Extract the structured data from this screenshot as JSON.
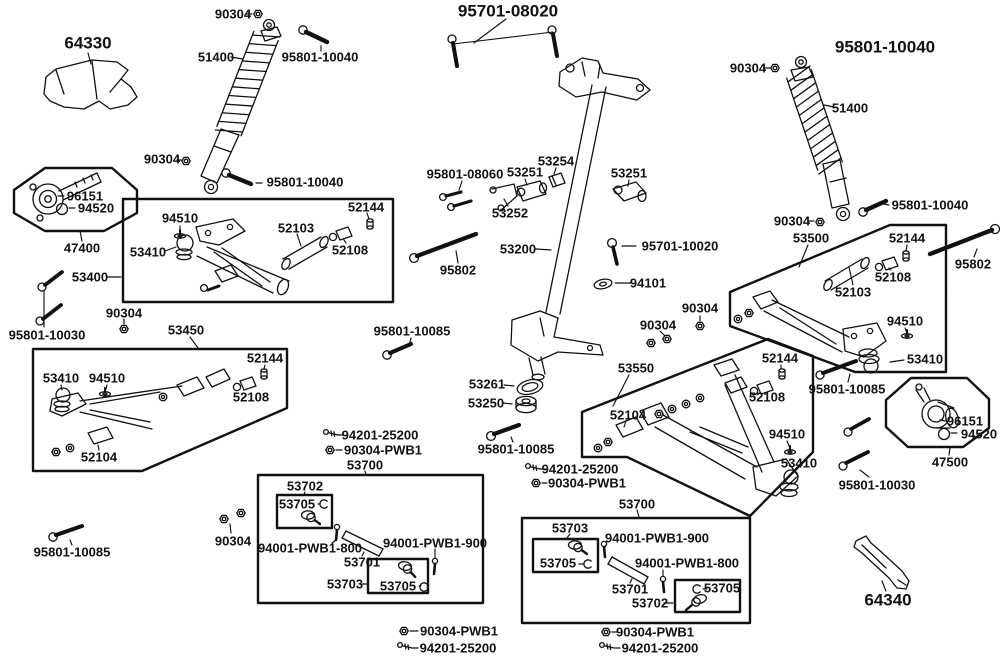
{
  "diagram_type": "exploded-parts-diagram",
  "colors": {
    "background": "#ffffff",
    "line": "#111111",
    "text": "#111111"
  },
  "icons": {
    "nut": "hex-nut-icon",
    "screw": "screw-icon",
    "clip": "snap-ring-icon",
    "washer": "flat-washer-icon",
    "balljoint": "ball-joint-icon"
  },
  "labels": [
    {
      "text": "64330"
    },
    {
      "text": "90304"
    },
    {
      "text": "95801-10040"
    },
    {
      "text": "51400"
    },
    {
      "text": "90304"
    },
    {
      "text": "95801-10040"
    },
    {
      "text": "95701-08020"
    },
    {
      "text": "95801-10040"
    },
    {
      "text": "90304"
    },
    {
      "text": "51400"
    },
    {
      "text": "95801-10040"
    },
    {
      "text": "90304"
    },
    {
      "text": "96151"
    },
    {
      "text": "94520"
    },
    {
      "text": "47400"
    },
    {
      "text": "94510"
    },
    {
      "text": "53410"
    },
    {
      "text": "52103"
    },
    {
      "text": "52144"
    },
    {
      "text": "52108"
    },
    {
      "text": "53400"
    },
    {
      "text": "90304"
    },
    {
      "text": "95801-10030"
    },
    {
      "text": "53450"
    },
    {
      "text": "95801-10085"
    },
    {
      "text": "95801-08060"
    },
    {
      "text": "53251"
    },
    {
      "text": "53254"
    },
    {
      "text": "53252"
    },
    {
      "text": "53251"
    },
    {
      "text": "53200"
    },
    {
      "text": "95802"
    },
    {
      "text": "95701-10020"
    },
    {
      "text": "94101"
    },
    {
      "text": "90304"
    },
    {
      "text": "90304"
    },
    {
      "text": "53500"
    },
    {
      "text": "52144"
    },
    {
      "text": "95802"
    },
    {
      "text": "52108"
    },
    {
      "text": "52103"
    },
    {
      "text": "94510"
    },
    {
      "text": "53410"
    },
    {
      "text": "95801-10085"
    },
    {
      "text": "53261"
    },
    {
      "text": "53250"
    },
    {
      "text": "53410"
    },
    {
      "text": "94510"
    },
    {
      "text": "52144"
    },
    {
      "text": "52108"
    },
    {
      "text": "52104"
    },
    {
      "text": "53550"
    },
    {
      "text": "52104"
    },
    {
      "text": "52144"
    },
    {
      "text": "52108"
    },
    {
      "text": "94510"
    },
    {
      "text": "53410"
    },
    {
      "text": "96151"
    },
    {
      "text": "94520"
    },
    {
      "text": "47500"
    },
    {
      "text": "95801-10030"
    },
    {
      "text": "94201-25200"
    },
    {
      "text": "90304-PWB1"
    },
    {
      "text": "53700"
    },
    {
      "text": "53702"
    },
    {
      "text": "53705"
    },
    {
      "text": "94001-PWB1-800"
    },
    {
      "text": "53701"
    },
    {
      "text": "94001-PWB1-900"
    },
    {
      "text": "53703"
    },
    {
      "text": "53705"
    },
    {
      "text": "90304"
    },
    {
      "text": "95801-10085"
    },
    {
      "text": "95801-10085"
    },
    {
      "text": "94201-25200"
    },
    {
      "text": "90304-PWB1"
    },
    {
      "text": "53700"
    },
    {
      "text": "53703"
    },
    {
      "text": "53705"
    },
    {
      "text": "94001-PWB1-900"
    },
    {
      "text": "53701"
    },
    {
      "text": "94001-PWB1-800"
    },
    {
      "text": "53702"
    },
    {
      "text": "53705"
    },
    {
      "text": "90304-PWB1"
    },
    {
      "text": "94201-25200"
    },
    {
      "text": "90304-PWB1"
    },
    {
      "text": "94201-25200"
    },
    {
      "text": "64340"
    }
  ]
}
